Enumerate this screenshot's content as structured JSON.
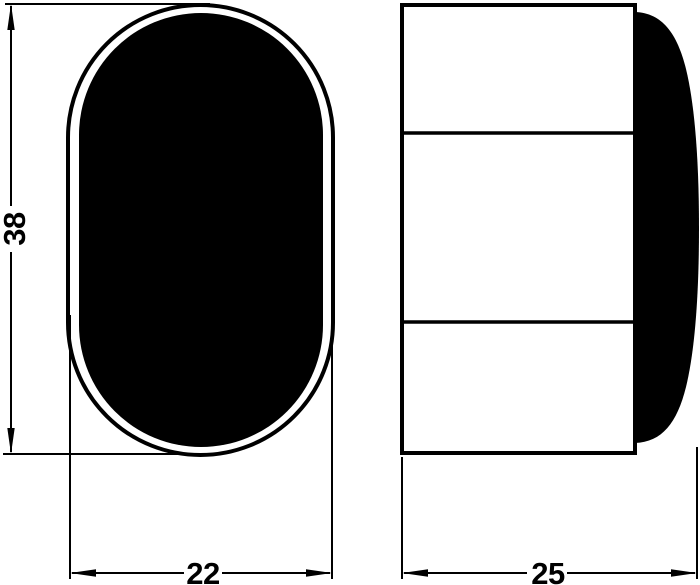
{
  "drawing": {
    "front_view": {
      "height_label": "38",
      "width_label": "22"
    },
    "side_view": {
      "depth_label": "25"
    },
    "colors": {
      "line": "#000000",
      "fill": "#000000",
      "background": "#ffffff"
    }
  }
}
